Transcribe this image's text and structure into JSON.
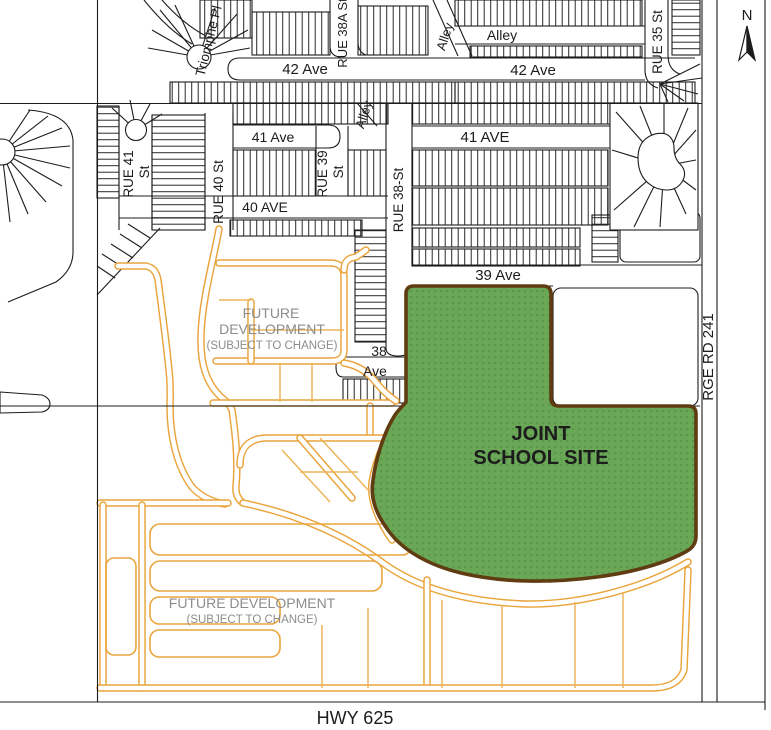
{
  "map": {
    "colors": {
      "school_fill": "#6aa857",
      "school_dot": "#5a9849",
      "school_border": "#5f3c12",
      "road_orange": "#e9a43c",
      "future_dev_text": "#8c8c8c",
      "linework": "#1c1c1c"
    },
    "labels": {
      "north": "N",
      "triomphe": "Triomphe Pl",
      "rue_38a": "RUE 38A St",
      "alley_nw": "Alley",
      "alley_n": "Alley",
      "alley_mid": "Alley",
      "ave42_w": "42 Ave",
      "ave42_e": "42 Ave",
      "rue35": "RUE 35 St",
      "rue41_a": "RUE 41",
      "rue41_b": "St",
      "ave41_w": "41 Ave",
      "rue40": "RUE 40 St",
      "rue39_a": "RUE 39",
      "rue39_b": "St",
      "ave40": "40 AVE",
      "ave41_e": "41 AVE",
      "rue38": "RUE 38-St",
      "ave39": "39 Ave",
      "ave38_a": "38",
      "ave38_b": "Ave",
      "fd_north_1": "FUTURE",
      "fd_north_2": "DEVELOPMENT",
      "fd_north_3": "(SUBJECT TO CHANGE)",
      "fd_south_1": "FUTURE DEVELOPMENT",
      "fd_south_2": "(SUBJECT TO CHANGE)",
      "school_1": "JOINT",
      "school_2": "SCHOOL SITE",
      "rge_rd": "RGE RD 241",
      "hwy": "HWY 625"
    }
  }
}
